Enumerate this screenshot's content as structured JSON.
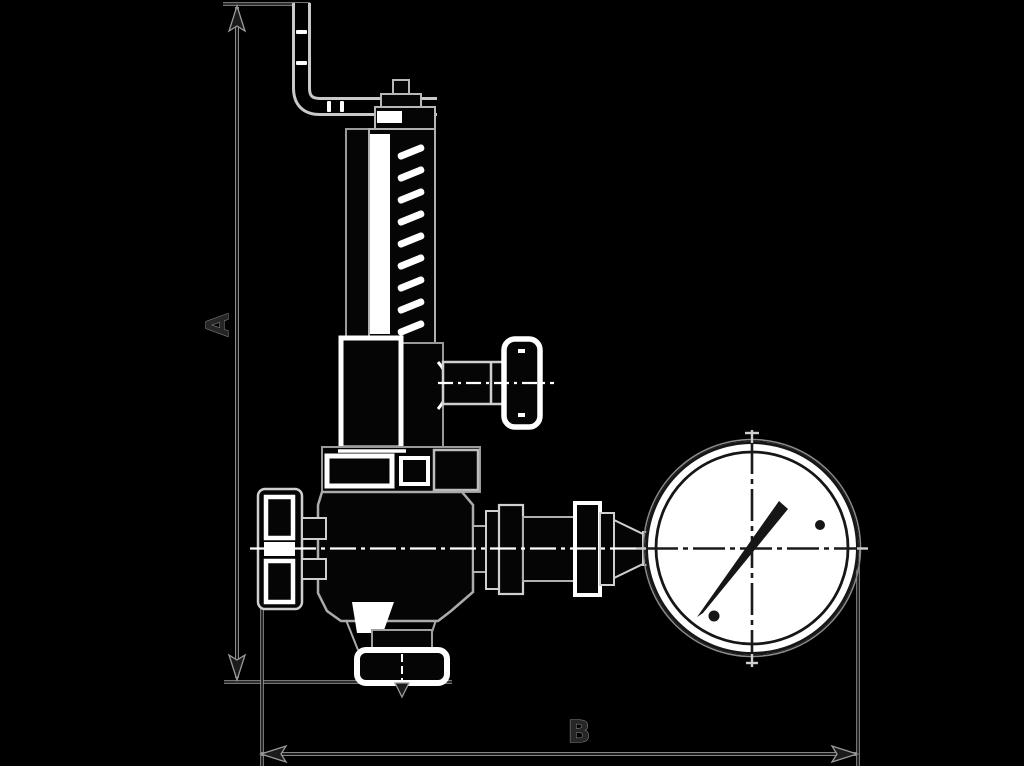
{
  "figure": {
    "type": "technical-dimension-drawing",
    "subject": "relief valve with lever, spring bonnet, side test knob, bottom outlet flange and pressure gauge",
    "dimension_labels": {
      "vertical": "A",
      "horizontal": "B"
    },
    "colors": {
      "background": "#000000",
      "ink": "#161616",
      "line_halo": "#9a9a9a",
      "highlight": "#ffffff"
    }
  }
}
